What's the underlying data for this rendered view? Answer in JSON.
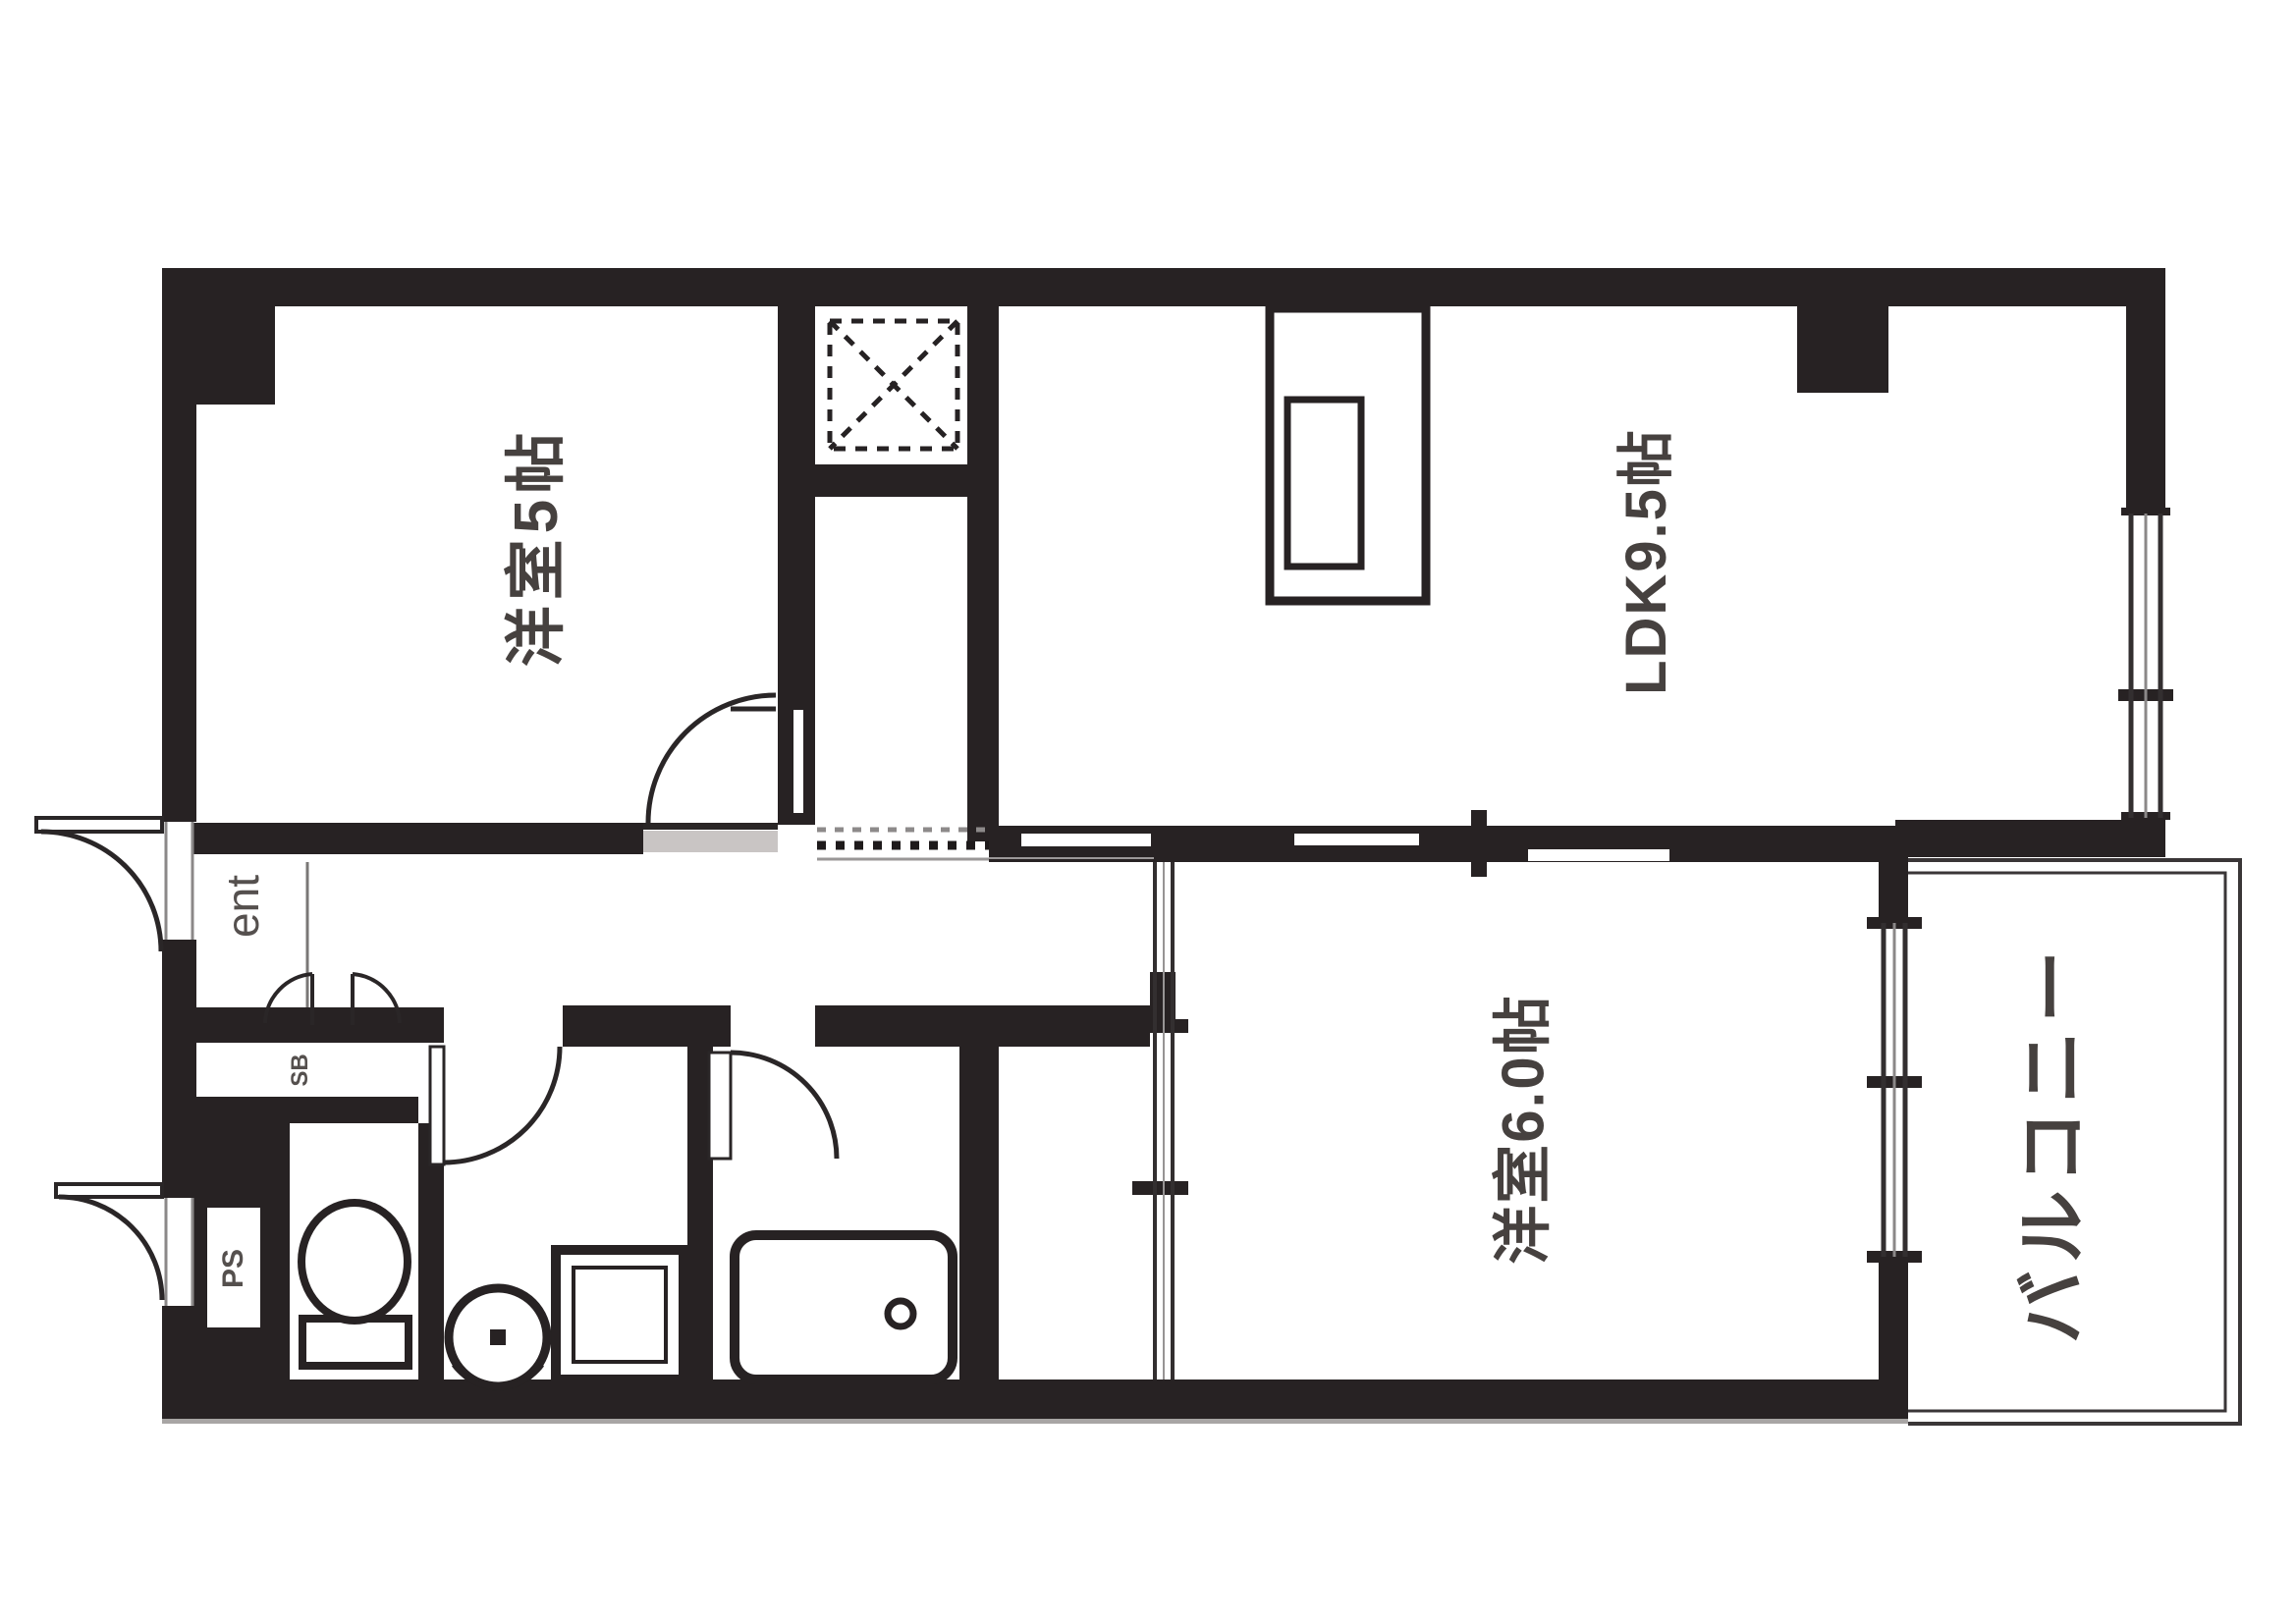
{
  "labels": {
    "room5": {
      "text": "洋室5帖"
    },
    "ldk": {
      "text": "LDK9.5帖"
    },
    "room6": {
      "text": "洋室6.0帖"
    },
    "balcony": {
      "text": "バルコニー"
    },
    "entrance": {
      "text": "ent"
    },
    "shoe_box": {
      "text": "SB"
    },
    "pipe_space": {
      "text": "PS"
    }
  },
  "colors": {
    "wall": "#272223",
    "line": "#3a3637",
    "thin_line": "#8b8888",
    "label_text": "#46413f",
    "background": "#ffffff"
  },
  "fixtures": [
    "kitchen-counter",
    "kitchen-sink",
    "refrigerator-space",
    "bathtub",
    "wash-basin",
    "washing-machine-pan",
    "toilet",
    "entrance-door",
    "meter-box-door",
    "balcony"
  ]
}
